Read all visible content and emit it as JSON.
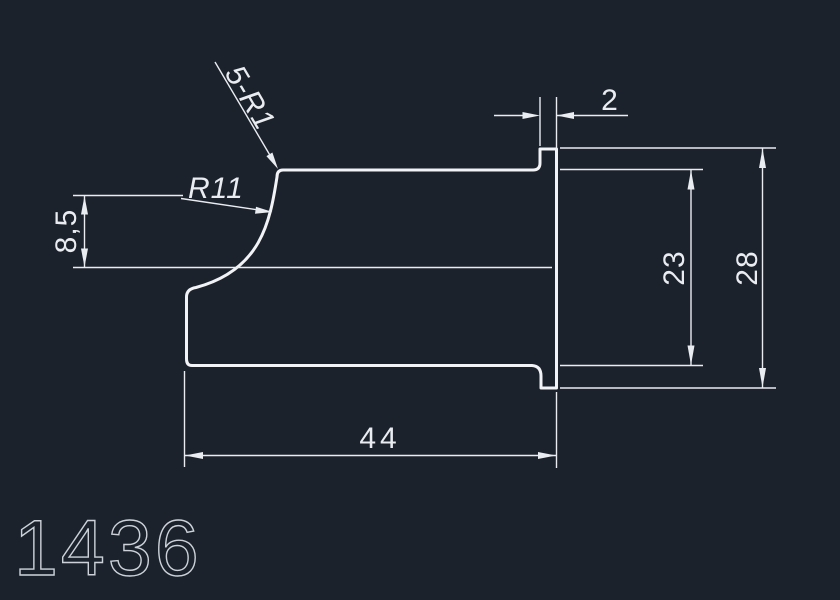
{
  "canvas": {
    "background_color": "#1c222c",
    "line_color": "#f1f3f6",
    "dimension_color": "#e9edf1",
    "drawing_number_color": "#ccd2d8"
  },
  "annotations": {
    "fillet_note": "5-R1",
    "radius_note": "R11"
  },
  "dimensions": {
    "cove_height": "8,5",
    "flange_width": "2",
    "inner_height": "23",
    "overall_height": "28",
    "overall_length": "44"
  },
  "drawing_number": "1436"
}
